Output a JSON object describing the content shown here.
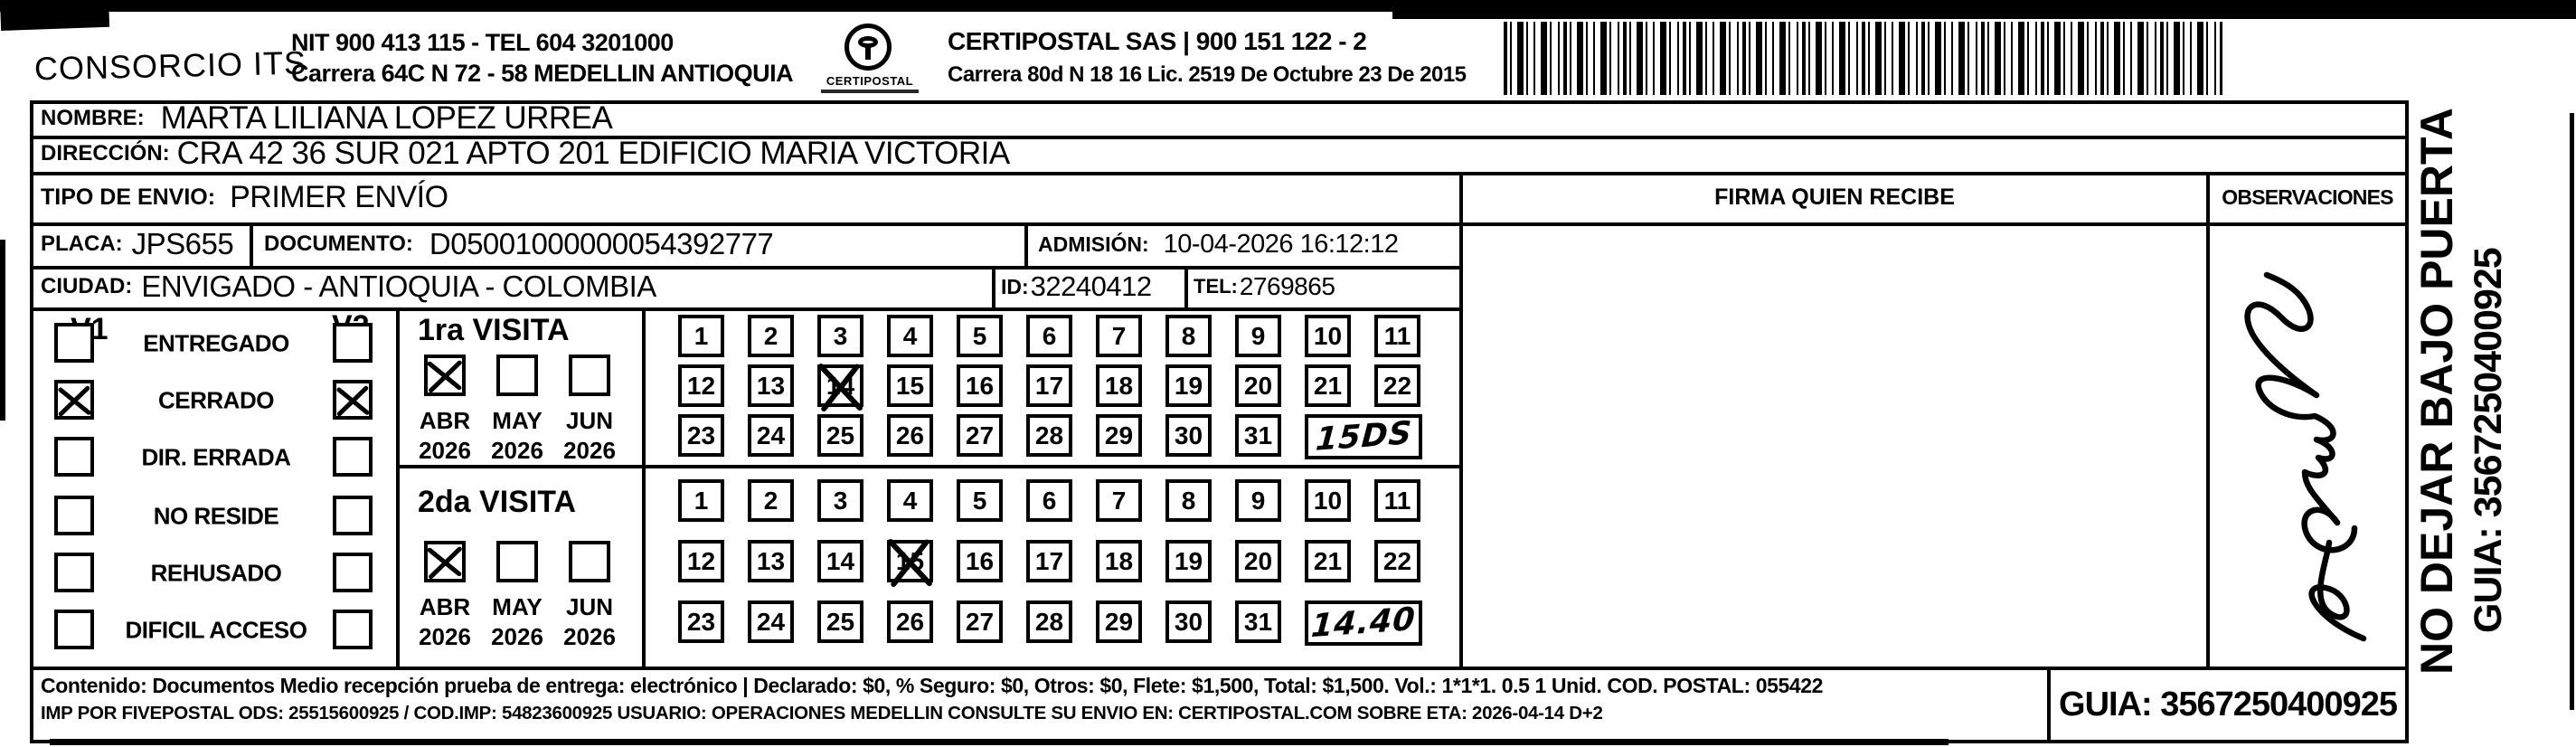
{
  "header": {
    "company": "CONSORCIO ITS",
    "nit_line": "NIT 900 413 115 - TEL 604 3201000",
    "address_line": "Carrera 64C N 72 - 58 MEDELLIN ANTIOQUIA",
    "logo_text": "CERTIPOSTAL",
    "certipostal_line1": "CERTIPOSTAL SAS | 900 151 122 - 2",
    "certipostal_line2": "Carrera 80d N 18 16  Lic. 2519 De Octubre 23 De 2015"
  },
  "recipient": {
    "nombre_label": "NOMBRE:",
    "nombre": "MARTA LILIANA LOPEZ URREA",
    "direccion_label": "DIRECCIÓN:",
    "direccion": "CRA 42  36 SUR 021 APTO 201 EDIFICIO MARIA VICTORIA",
    "tipo_envio_label": "TIPO DE ENVIO:",
    "tipo_envio": "PRIMER ENVÍO",
    "placa_label": "PLACA:",
    "placa": "JPS655",
    "documento_label": "DOCUMENTO:",
    "documento": "D05001000000054392777",
    "admision_label": "ADMISIÓN:",
    "admision": "10-04-2026 16:12:12",
    "ciudad_label": "CIUDAD:",
    "ciudad": "ENVIGADO - ANTIOQUIA - COLOMBIA",
    "id_label": "ID:",
    "id": "32240412",
    "tel_label": "TEL:",
    "tel": "2769865"
  },
  "status_panel": {
    "col1_header": "V1",
    "col2_header": "V2",
    "rows": [
      {
        "label": "ENTREGADO",
        "v1": false,
        "v2": false
      },
      {
        "label": "CERRADO",
        "v1": true,
        "v2": true
      },
      {
        "label": "DIR. ERRADA",
        "v1": false,
        "v2": false
      },
      {
        "label": "NO RESIDE",
        "v1": false,
        "v2": false
      },
      {
        "label": "REHUSADO",
        "v1": false,
        "v2": false
      },
      {
        "label": "DIFICIL ACCESO",
        "v1": false,
        "v2": false
      }
    ]
  },
  "visits": [
    {
      "title": "1ra VISITA",
      "months": [
        {
          "label": "ABR",
          "year": "2026",
          "checked": true
        },
        {
          "label": "MAY",
          "year": "2026",
          "checked": false
        },
        {
          "label": "JUN",
          "year": "2026",
          "checked": false
        }
      ],
      "days": [
        1,
        2,
        3,
        4,
        5,
        6,
        7,
        8,
        9,
        10,
        11,
        12,
        13,
        14,
        15,
        16,
        17,
        18,
        19,
        20,
        21,
        22,
        23,
        24,
        25,
        26,
        27,
        28,
        29,
        30,
        31
      ],
      "crossed_day": 14,
      "handwritten_note": "15DS"
    },
    {
      "title": "2da VISITA",
      "months": [
        {
          "label": "ABR",
          "year": "2026",
          "checked": true
        },
        {
          "label": "MAY",
          "year": "2026",
          "checked": false
        },
        {
          "label": "JUN",
          "year": "2026",
          "checked": false
        }
      ],
      "days": [
        1,
        2,
        3,
        4,
        5,
        6,
        7,
        8,
        9,
        10,
        11,
        12,
        13,
        14,
        15,
        16,
        17,
        18,
        19,
        20,
        21,
        22,
        23,
        24,
        25,
        26,
        27,
        28,
        29,
        30,
        31
      ],
      "crossed_day": 15,
      "handwritten_note": "14.40"
    }
  ],
  "firma": {
    "header": "FIRMA QUIEN RECIBE"
  },
  "observaciones": {
    "header": "OBSERVACIONES"
  },
  "side_text": {
    "line1": "NO DEJAR BAJO PUERTA",
    "line2": "GUIA: 3567250400925"
  },
  "footer": {
    "line1": "Contenido: Documentos Medio recepción prueba de entrega: electrónico | Declarado: $0, % Seguro: $0, Otros: $0, Flete: $1,500, Total: $1,500. Vol.: 1*1*1. 0.5  1 Unid. COD. POSTAL: 055422",
    "line2": "IMP POR FIVEPOSTAL ODS: 25515600925 / COD.IMP: 54823600925 USUARIO: OPERACIONES MEDELLIN CONSULTE SU ENVIO EN: CERTIPOSTAL.COM SOBRE ETA: 2026-04-14 D+2",
    "guia_box": "GUIA: 3567250400925"
  },
  "colors": {
    "ink": "#000000",
    "paper": "#ffffff"
  }
}
